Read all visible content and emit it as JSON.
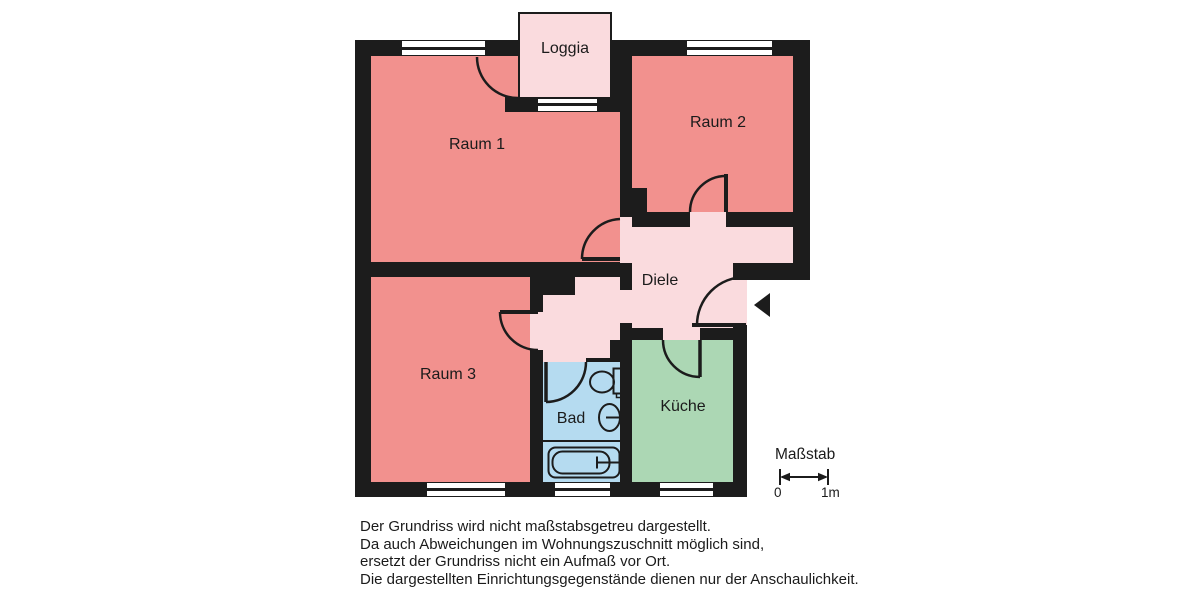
{
  "floorplan": {
    "wall_color": "#1c1c1c",
    "rooms": {
      "loggia": {
        "label": "Loggia",
        "color": "#fadbde"
      },
      "raum1": {
        "label": "Raum 1",
        "color": "#f2918e"
      },
      "raum2": {
        "label": "Raum 2",
        "color": "#f2918e"
      },
      "raum3": {
        "label": "Raum 3",
        "color": "#f2918e"
      },
      "diele": {
        "label": "Diele",
        "color": "#fadbde"
      },
      "bad": {
        "label": "Bad",
        "color": "#b5dbf0"
      },
      "kueche": {
        "label": "Küche",
        "color": "#acd7b4"
      }
    },
    "symbols": [
      "window-symbol",
      "door-arc",
      "entrance-arrow-icon"
    ],
    "fixtures": [
      "toilet-icon",
      "sink-icon",
      "bathtub-icon"
    ]
  },
  "scale": {
    "title": "Maßstab",
    "start_label": "0",
    "end_label": "1m"
  },
  "disclaimer": {
    "lines": [
      "Der Grundriss wird nicht maßstabsgetreu dargestellt.",
      "Da auch Abweichungen im Wohnungszuschnitt möglich sind,",
      "ersetzt der Grundriss nicht ein Aufmaß vor Ort.",
      "Die dargestellten Einrichtungsgegenstände dienen nur der Anschaulichkeit."
    ]
  }
}
